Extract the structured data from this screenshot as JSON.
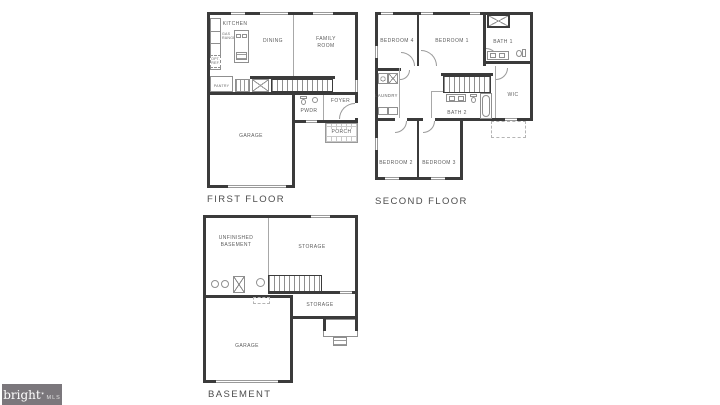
{
  "watermark": {
    "brand": "bright",
    "star": "✶",
    "suffix": "MLS"
  },
  "first_floor": {
    "title": "FIRST FLOOR",
    "labels": {
      "kitchen": "KITCHEN",
      "dining": "DINING",
      "family_room": "FAMILY ROOM",
      "pantry": "PANTRY",
      "gas_range": "GAS RANGE",
      "opt_ref": "OPT. REF.",
      "garage": "GARAGE",
      "pwdr": "PWDR",
      "foyer": "FOYER",
      "porch": "PORCH"
    }
  },
  "second_floor": {
    "title": "SECOND FLOOR",
    "labels": {
      "bedroom4": "BEDROOM 4",
      "bedroom1": "BEDROOM 1",
      "bath1": "BATH 1",
      "laundry": "LAUNDRY",
      "wic": "WIC",
      "bath2": "BATH 2",
      "bedroom2": "BEDROOM 2",
      "bedroom3": "BEDROOM 3"
    }
  },
  "basement": {
    "title": "BASEMENT",
    "labels": {
      "unfinished_basement": "UNFINISHED BASEMENT",
      "storage_upper": "STORAGE",
      "storage_lower": "STORAGE",
      "garage": "GARAGE"
    }
  },
  "colors": {
    "wall": "#3b3b3b",
    "thin_line": "#9a9a9a",
    "label": "#5d5d5d",
    "watermark_bg": "#7b777c"
  }
}
